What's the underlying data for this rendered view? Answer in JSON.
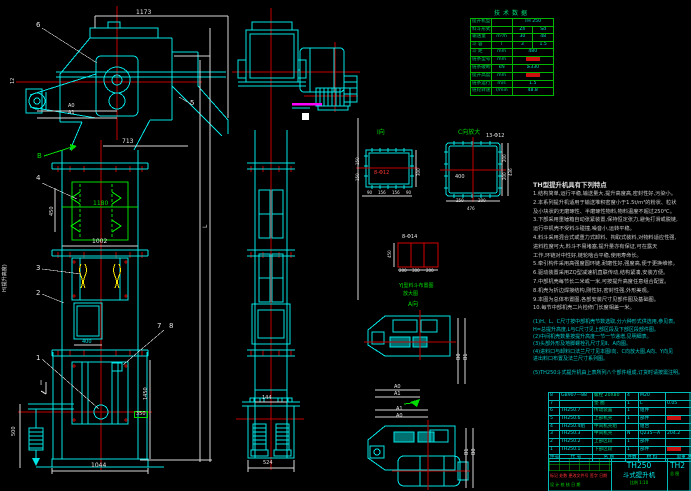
{
  "meta": {
    "sheet": "TH250 bucket elevator general drawing"
  },
  "spec_table": {
    "title": "技术数据",
    "rows": [
      {
        "label": "提升机型号",
        "unit": "",
        "v1": "TH 250",
        "span": true
      },
      {
        "label": "料斗形式",
        "unit": "",
        "v1": "Zh",
        "v2": "Sd"
      },
      {
        "label": "输送量",
        "unit": "m³/h",
        "v1": "30",
        "v2": "48"
      },
      {
        "label": "斗  容",
        "unit": "l",
        "v1": "3",
        "v2": "1.5"
      },
      {
        "label": "斗  距",
        "unit": "mm",
        "v1": "480",
        "span": true
      },
      {
        "label": "链条型号",
        "unit": "mm",
        "v1": "",
        "span": true,
        "red": true
      },
      {
        "label": "链条破断拉力",
        "unit": "kN",
        "v1": "≥330",
        "span": true
      },
      {
        "label": "提升高度",
        "unit": "mm",
        "v1": "",
        "span": true,
        "red": true
      },
      {
        "label": "链条运行速度",
        "unit": "m/s",
        "v1": "1.5",
        "span": true
      },
      {
        "label": "链轮转速",
        "unit": "r/min",
        "v1": "48.8",
        "span": true
      }
    ]
  },
  "features": {
    "title": "TH型提升机具有下列特点",
    "lines": [
      {
        "t": "1.结构简单,运行平稳,输送量大,提升高度高,密封性好,污染小。",
        "cls": "wt"
      },
      {
        "t": "2.本系列提升机适用于输送堆积密度小于1.5t/m³的粉状、粒状",
        "cls": "wt"
      },
      {
        "t": "  及小块状的无磨琢性、半磨琢性物料,物料温度不超过250℃。",
        "cls": "wt"
      },
      {
        "t": "3.下部采用重锤箱自动张紧装置,保持恒定张力,避免打滑或脱链,",
        "cls": "wt"
      },
      {
        "t": "  运行中机壳不受料斗碰撞,噪音小,运转平稳。",
        "cls": "wt"
      },
      {
        "t": "4.料斗采用混合式或重力式卸料、掏取式装料,对物料适应性强,",
        "cls": "wt"
      },
      {
        "t": "  进料粒度可大,料斗不易堵塞,提升量亦有保证,可在露天",
        "cls": "wt"
      },
      {
        "t": "  工作,环链对中性好,链轮啮合平稳,使用寿命长。",
        "cls": "wt"
      },
      {
        "t": "5.牵引构件采用高强度圆环链,耐磨性好,强度高,便于更换维修。",
        "cls": "wt"
      },
      {
        "t": "6.驱动装置采用ZQ型减速机直联传动,结构紧凑,安装方便。",
        "cls": "wt"
      },
      {
        "t": "7.中部机壳每节长二米或一米,可按提升高度任意组合配置。",
        "cls": "wt"
      },
      {
        "t": "8.机壳为折边焊接结构,刚性好,密封性强,外形美观。",
        "cls": "wt"
      },
      {
        "t": "9.本图为总体布置图,各部安装尺寸见部件图及基础图。",
        "cls": "wt"
      },
      {
        "t": "10.每节中部机壳二片检修门长度相差一米。",
        "cls": "wt"
      },
      {
        "t": "(1)H、L、C尺寸按中部机壳节数选取,分六种形式供选用,参见表。",
        "cls": "cy gap"
      },
      {
        "t": "  H=总提升高度,L与C尺寸见上部区段及下部区段部件图。",
        "cls": "cy"
      },
      {
        "t": "(2)中间机壳数量按提升高度一节一节递增,见明细表。",
        "cls": "cy"
      },
      {
        "t": "(3)头部外形及地脚螺栓孔尺寸见Ⅱ、A向图。",
        "cls": "cy"
      },
      {
        "t": "(4)进料口与卸料口法兰尺寸见本图I向、C向放大图,A向、Y向见",
        "cls": "cy"
      },
      {
        "t": "  进出料口布置及法兰尺寸系列图。",
        "cls": "cy"
      },
      {
        "t": "(5)TH250斗式提升机由上表所列八个部件组成,订货时请按需注明。",
        "cls": "cy gap"
      }
    ]
  },
  "bom": {
    "header": {
      "no": "件号",
      "code": "代 号",
      "name": "名 称",
      "qty": "件数",
      "mat": "材 料",
      "note": "单重 总重"
    },
    "rows": [
      {
        "no": "8",
        "code": "GB907—88",
        "name": "螺栓 20X80",
        "qty": "4",
        "mat": "M20",
        "note": ""
      },
      {
        "no": "7",
        "code": "",
        "name": "垫 圈",
        "qty": "1",
        "mat": "L",
        "note": "0.05"
      },
      {
        "no": "6",
        "code": "TH250.7",
        "name": "传动装置",
        "qty": "1",
        "mat": "组件",
        "note": ""
      },
      {
        "no": "5",
        "code": "TH250.6",
        "name": "上部机壳",
        "qty": "1",
        "mat": "部件",
        "note": "",
        "red": true
      },
      {
        "no": "4",
        "code": "TH250.4组",
        "name": "中间机壳组",
        "qty": "",
        "mat": "组合",
        "note": ""
      },
      {
        "no": "3",
        "code": "TH250.3",
        "name": "中间机壳",
        "qty": "N",
        "mat": "Q235—A",
        "note": "204.2"
      },
      {
        "no": "2",
        "code": "TH250.2",
        "name": "上部区段",
        "qty": "1",
        "mat": "部件",
        "note": ""
      },
      {
        "no": "1",
        "code": "TH250.1",
        "name": "下部区段",
        "qty": "1",
        "mat": "部件",
        "note": "",
        "red": true
      }
    ]
  },
  "title_block": {
    "model": "TH250",
    "name": "斗式提升机",
    "scale": "比例 1:10",
    "right_model": "TH2",
    "right_note": "总 图",
    "rev_row": "标记 处数 更改文件号 签字 日期",
    "sign_row": "设 计  校 核  日 期"
  },
  "colors": {
    "line_cyan": "#00e5e5",
    "line_green": "#00dc00",
    "line_red": "#d40000",
    "magenta": "#ff00ff",
    "yellow": "#ffe800"
  },
  "annotations": [
    {
      "t": "1173",
      "x": 136,
      "y": 10,
      "c": "w",
      "s": 6
    },
    {
      "t": "6",
      "x": 36,
      "y": 22,
      "c": "w",
      "s": 7
    },
    {
      "t": "12",
      "x": 11,
      "y": 84,
      "c": "w",
      "s": 5,
      "r": -90
    },
    {
      "t": "A0",
      "x": 68,
      "y": 104,
      "c": "w",
      "s": 5
    },
    {
      "t": "A1",
      "x": 68,
      "y": 111,
      "c": "w",
      "s": 5
    },
    {
      "t": "5",
      "x": 190,
      "y": 100,
      "c": "w",
      "s": 7
    },
    {
      "t": "B",
      "x": 37,
      "y": 153,
      "c": "g",
      "s": 7
    },
    {
      "t": "713",
      "x": 122,
      "y": 139,
      "c": "w",
      "s": 6
    },
    {
      "t": "4",
      "x": 36,
      "y": 175,
      "c": "w",
      "s": 7
    },
    {
      "t": "450",
      "x": 50,
      "y": 216,
      "c": "w",
      "s": 5,
      "r": -90
    },
    {
      "t": "1180",
      "x": 93,
      "y": 201,
      "c": "g",
      "s": 6
    },
    {
      "t": "1002",
      "x": 92,
      "y": 239,
      "c": "w",
      "s": 6
    },
    {
      "t": "3",
      "x": 36,
      "y": 265,
      "c": "w",
      "s": 7
    },
    {
      "t": "2",
      "x": 36,
      "y": 290,
      "c": "w",
      "s": 7
    },
    {
      "t": "H(提升高度)",
      "x": 3,
      "y": 292,
      "c": "w",
      "s": 5,
      "r": -90
    },
    {
      "t": "L",
      "x": 203,
      "y": 228,
      "c": "w",
      "s": 6,
      "r": -90
    },
    {
      "t": "7",
      "x": 157,
      "y": 323,
      "c": "w",
      "s": 7
    },
    {
      "t": "8",
      "x": 169,
      "y": 323,
      "c": "w",
      "s": 7
    },
    {
      "t": "400",
      "x": 82,
      "y": 340,
      "c": "c",
      "s": 5
    },
    {
      "t": "1",
      "x": 36,
      "y": 355,
      "c": "w",
      "s": 7
    },
    {
      "t": "I",
      "x": 40,
      "y": 380,
      "c": "w",
      "s": 7
    },
    {
      "t": "1450",
      "x": 144,
      "y": 400,
      "c": "w",
      "s": 5,
      "r": -90
    },
    {
      "t": "350",
      "x": 134,
      "y": 411,
      "c": "w",
      "s": 5,
      "box": true
    },
    {
      "t": "500",
      "x": 12,
      "y": 436,
      "c": "w",
      "s": 5,
      "r": -90
    },
    {
      "t": "1044",
      "x": 91,
      "y": 463,
      "c": "w",
      "s": 6
    },
    {
      "t": "144",
      "x": 262,
      "y": 396,
      "c": "w",
      "s": 5
    },
    {
      "t": "524",
      "x": 263,
      "y": 461,
      "c": "w",
      "s": 5
    },
    {
      "t": "I向",
      "x": 377,
      "y": 130,
      "c": "g",
      "s": 6
    },
    {
      "t": "8-Φ12",
      "x": 374,
      "y": 171,
      "c": "r",
      "s": 5
    },
    {
      "t": "150",
      "x": 356,
      "y": 165,
      "c": "w",
      "s": 4,
      "r": -90
    },
    {
      "t": "150",
      "x": 356,
      "y": 181,
      "c": "w",
      "s": 4,
      "r": -90
    },
    {
      "t": "300",
      "x": 417,
      "y": 176,
      "c": "w",
      "s": 4,
      "r": -90
    },
    {
      "t": "90",
      "x": 367,
      "y": 191,
      "c": "w",
      "s": 4
    },
    {
      "t": "156",
      "x": 378,
      "y": 191,
      "c": "w",
      "s": 4
    },
    {
      "t": "156",
      "x": 392,
      "y": 191,
      "c": "w",
      "s": 4
    },
    {
      "t": "90",
      "x": 406,
      "y": 191,
      "c": "w",
      "s": 4
    },
    {
      "t": "C向放大",
      "x": 458,
      "y": 130,
      "c": "g",
      "s": 6
    },
    {
      "t": "13-Φ12",
      "x": 486,
      "y": 134,
      "c": "w",
      "s": 5
    },
    {
      "t": "400",
      "x": 455,
      "y": 175,
      "c": "w",
      "s": 5
    },
    {
      "t": "200",
      "x": 503,
      "y": 162,
      "c": "w",
      "s": 4,
      "r": -90
    },
    {
      "t": "200",
      "x": 503,
      "y": 180,
      "c": "w",
      "s": 4,
      "r": -90
    },
    {
      "t": "436",
      "x": 509,
      "y": 176,
      "c": "w",
      "s": 4,
      "r": -90
    },
    {
      "t": "250",
      "x": 456,
      "y": 199,
      "c": "w",
      "s": 4
    },
    {
      "t": "200",
      "x": 478,
      "y": 199,
      "c": "w",
      "s": 4
    },
    {
      "t": "476",
      "x": 467,
      "y": 207,
      "c": "w",
      "s": 4
    },
    {
      "t": "8-Φ14",
      "x": 402,
      "y": 235,
      "c": "w",
      "s": 5
    },
    {
      "t": "450",
      "x": 388,
      "y": 258,
      "c": "w",
      "s": 4,
      "r": -90
    },
    {
      "t": "200",
      "x": 399,
      "y": 269,
      "c": "w",
      "s": 4
    },
    {
      "t": "300",
      "x": 412,
      "y": 269,
      "c": "w",
      "s": 4
    },
    {
      "t": "200",
      "x": 426,
      "y": 269,
      "c": "w",
      "s": 4
    },
    {
      "t": "YJ型料斗布置图",
      "x": 399,
      "y": 284,
      "c": "g",
      "s": 5
    },
    {
      "t": "放大图",
      "x": 403,
      "y": 292,
      "c": "g",
      "s": 5
    },
    {
      "t": "A向",
      "x": 408,
      "y": 302,
      "c": "g",
      "s": 6
    },
    {
      "t": "A0",
      "x": 394,
      "y": 385,
      "c": "w",
      "s": 5
    },
    {
      "t": "A1",
      "x": 394,
      "y": 392,
      "c": "w",
      "s": 5
    },
    {
      "t": "B0",
      "x": 457,
      "y": 360,
      "c": "w",
      "s": 5,
      "r": -90
    },
    {
      "t": "B1",
      "x": 464,
      "y": 360,
      "c": "w",
      "s": 5,
      "r": -90
    },
    {
      "t": "A1",
      "x": 396,
      "y": 407,
      "c": "w",
      "s": 5
    },
    {
      "t": "A0",
      "x": 396,
      "y": 414,
      "c": "w",
      "s": 5
    },
    {
      "t": "B1",
      "x": 465,
      "y": 455,
      "c": "w",
      "s": 5,
      "r": -90
    },
    {
      "t": "B0",
      "x": 472,
      "y": 455,
      "c": "w",
      "s": 5,
      "r": -90
    }
  ]
}
